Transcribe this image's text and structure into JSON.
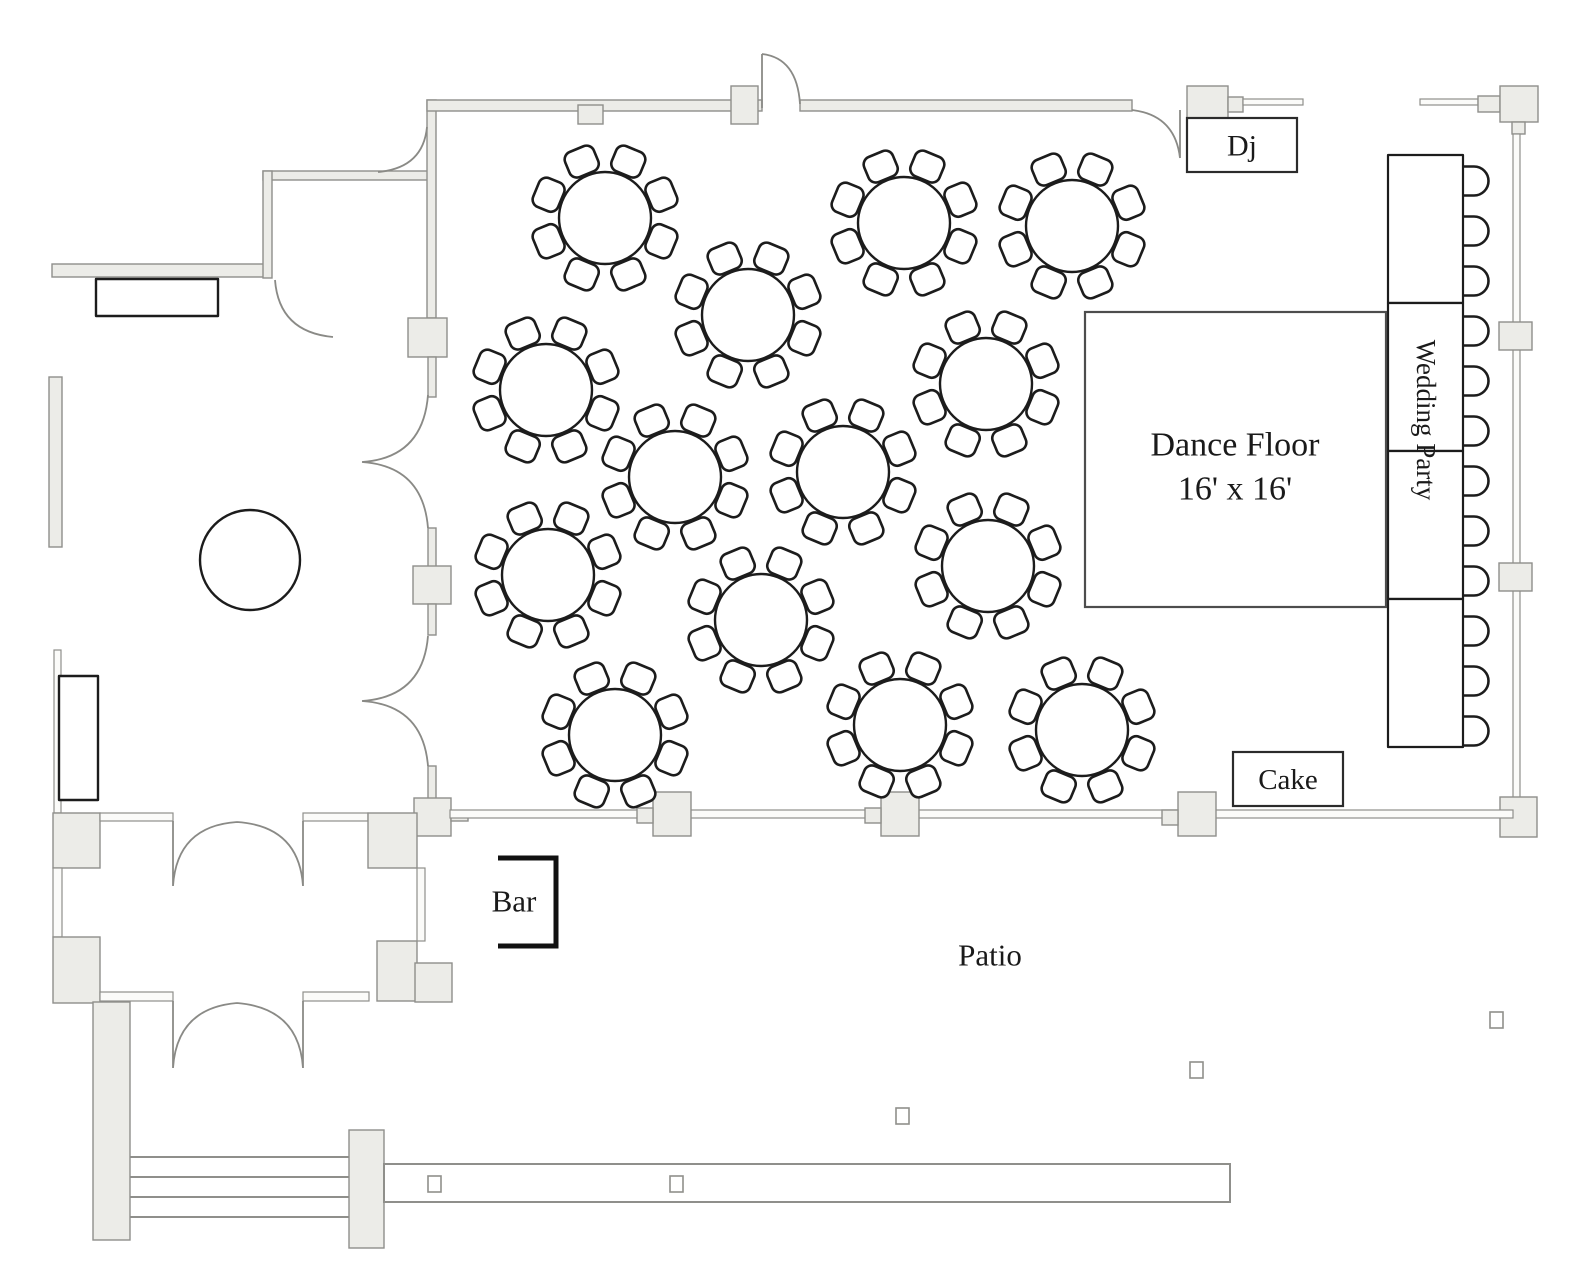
{
  "page_title": "Wedding Reception Floor Plan",
  "labels": {
    "dj": "Dj",
    "dance_floor_line1": "Dance Floor",
    "dance_floor_line2": "16' x 16'",
    "wedding_party": "Wedding Party",
    "cake": "Cake",
    "bar": "Bar",
    "patio": "Patio"
  },
  "colors": {
    "wall_fill": "#ecece8",
    "wall_stroke": "#8f8f8b",
    "window_fill": "#fbfbf9",
    "furniture_stroke": "#1c1c1c",
    "door_arc_stroke": "#8a8a86",
    "label_color": "#1a1a1a",
    "dance_floor_stroke": "#4d4d4d"
  },
  "diagram": {
    "round_tables": {
      "count": 14,
      "seats_per_table": 8,
      "table_radius": 46,
      "chair": {
        "width": 31,
        "depth": 27,
        "corner_radius": 8,
        "offset": 61,
        "angle_offset_deg": 22.5
      },
      "centers": [
        [
          605,
          218
        ],
        [
          748,
          315
        ],
        [
          904,
          223
        ],
        [
          1072,
          226
        ],
        [
          546,
          390
        ],
        [
          986,
          384
        ],
        [
          675,
          477
        ],
        [
          843,
          472
        ],
        [
          988,
          566
        ],
        [
          548,
          575
        ],
        [
          761,
          620
        ],
        [
          900,
          725
        ],
        [
          615,
          735
        ],
        [
          1082,
          730
        ]
      ]
    },
    "head_table": {
      "x": 1388,
      "top": 155,
      "width": 75,
      "segment_height": 148,
      "segments": 4,
      "chairs": {
        "count": 12,
        "x": 1462,
        "first_center_y": 181,
        "pitch": 50,
        "width": 27,
        "height": 29
      }
    },
    "dance_floor": {
      "x": 1085,
      "y": 312,
      "width": 301,
      "height": 295
    },
    "round_side_table": {
      "cx": 250,
      "cy": 560,
      "r": 50
    },
    "dj_box": {
      "x": 1187,
      "y": 118,
      "width": 110,
      "height": 54
    },
    "cake_box": {
      "x": 1233,
      "y": 752,
      "width": 110,
      "height": 54
    },
    "bar_bracket": {
      "x1": 498,
      "y1": 858,
      "x2": 556,
      "y2": 946
    },
    "patio_label_pos": {
      "x": 990,
      "y": 955
    },
    "patio_posts": [
      [
        1490,
        1012
      ],
      [
        1190,
        1062
      ],
      [
        896,
        1108
      ],
      [
        428,
        1176
      ],
      [
        670,
        1176
      ]
    ],
    "post_size": {
      "width": 13,
      "height": 16
    }
  }
}
